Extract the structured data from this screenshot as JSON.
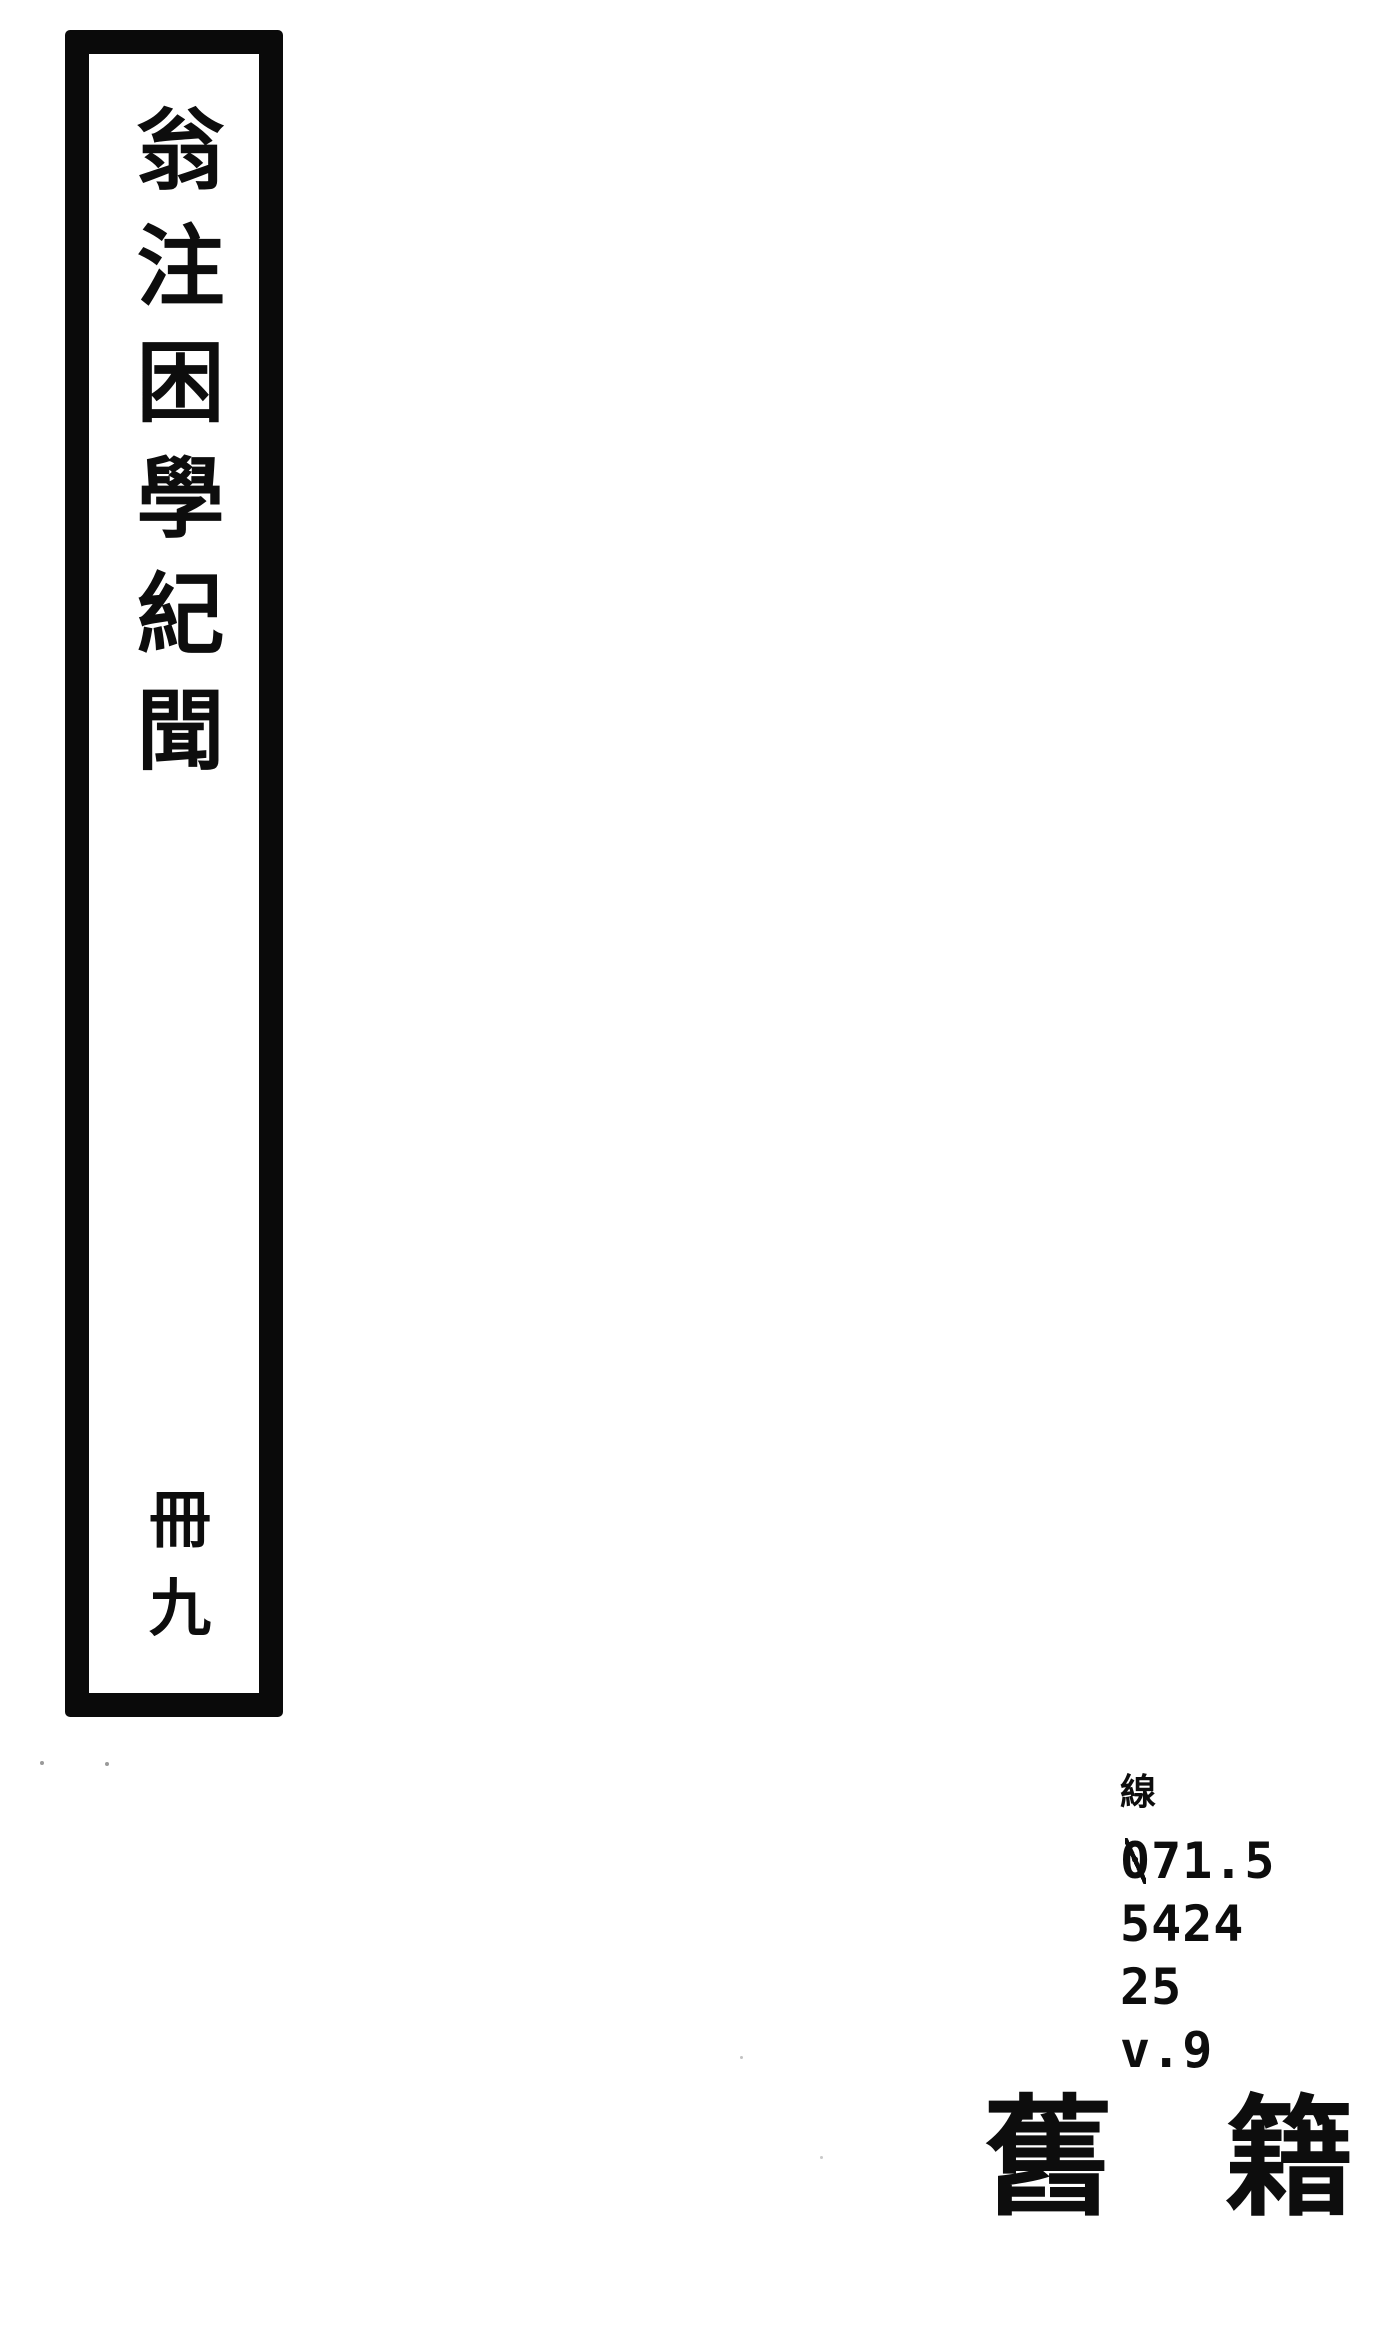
{
  "colors": {
    "paper": "#ffffff",
    "ink": "#0d0d0d",
    "frame": "#0a0a0a"
  },
  "spine": {
    "title": "翁注困學紀聞",
    "volume": "冊九"
  },
  "call_number": {
    "prefix": "線",
    "lines": [
      "071.5",
      "5424",
      "25",
      "v.9"
    ]
  },
  "collection_label": {
    "chars": [
      "舊",
      "籍"
    ]
  }
}
